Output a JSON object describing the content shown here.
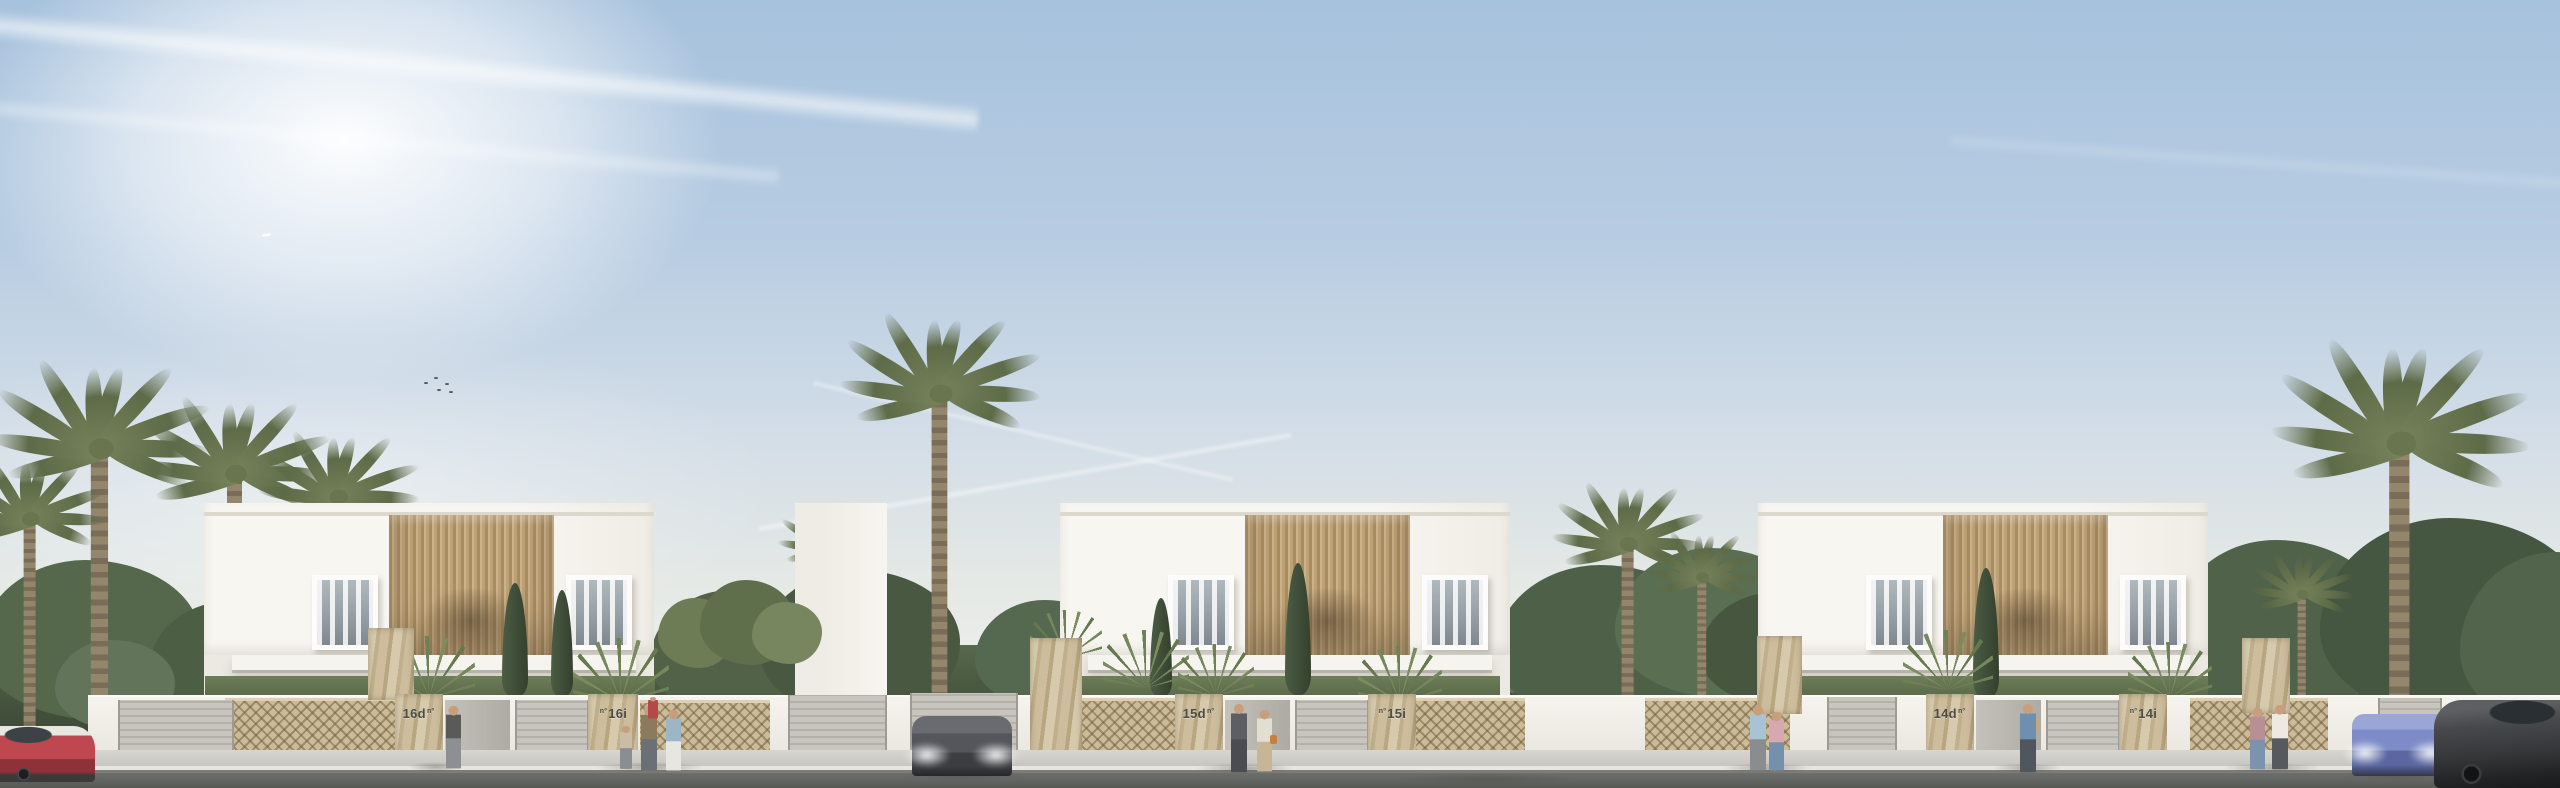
{
  "scene": {
    "setting": "Street-elevation architectural render: three identical white two-storey duplex villas with vertical wood-slat facade screens, stone gate pillars, garden walls with stone lattice panels, palm trees, pedestrians and parked cars under a clear sky with contrails and sun glow at top-left",
    "sky": {
      "sun_glow": "top-left",
      "contrail_count": 4,
      "bird_count": 5
    }
  },
  "villas": [
    {
      "block": "16",
      "plaques": [
        {
          "unit": "16d",
          "mark": "nº",
          "mark_position": "after"
        },
        {
          "unit": "16i",
          "mark": "nº",
          "mark_position": "before"
        }
      ]
    },
    {
      "block": "15",
      "plaques": [
        {
          "unit": "15d",
          "mark": "nº",
          "mark_position": "after"
        },
        {
          "unit": "15i",
          "mark": "nº",
          "mark_position": "before"
        }
      ]
    },
    {
      "block": "14",
      "plaques": [
        {
          "unit": "14d",
          "mark": "nº",
          "mark_position": "after"
        },
        {
          "unit": "14i",
          "mark": "nº",
          "mark_position": "before"
        }
      ]
    }
  ],
  "cars": [
    {
      "name": "red-hatchback-white-roof",
      "color": "#b5444c",
      "position": "far-left-street",
      "headlights_on": false
    },
    {
      "name": "dark-gray-sports-car",
      "color": "#5f6065",
      "position": "driveway-between-villas-16-and-15",
      "headlights_on": true
    },
    {
      "name": "blue-fastback-sedan",
      "color": "#5e83ac",
      "position": "street-in-front-of-villa-15",
      "headlights_on": false
    },
    {
      "name": "violet-blue-sedan",
      "color": "#7d8cc8",
      "position": "right-driveway",
      "headlights_on": true
    },
    {
      "name": "dark-gray-sedan",
      "color": "#46484b",
      "position": "far-right-street",
      "headlights_on": false
    }
  ],
  "people_groups": [
    {
      "location": "villa-16 left gate",
      "count": 1
    },
    {
      "location": "villa-16 right gate",
      "count": 4
    },
    {
      "location": "villa-15 sidewalk",
      "count": 2
    },
    {
      "location": "between villa-15 and villa-14",
      "count": 2
    },
    {
      "location": "villa-14 left gate",
      "count": 1
    },
    {
      "location": "right end of sidewalk",
      "count": 2
    }
  ],
  "palette": {
    "sky_top": "#a7c2dd",
    "sky_horizon": "#edeeea",
    "facade_white": "#f8f6f1",
    "wood_slat_light": "#ccb289",
    "wood_slat_dark": "#a98c62",
    "stone": "#d0c2a2",
    "lattice": "#cbbc99",
    "gate_gray": "#c7c5bd",
    "greenery": "#57684d",
    "cypress": "#3a4a34",
    "sidewalk": "#c6c4be",
    "asphalt": "#6d6f6c",
    "plaque_text": "#4d4c47"
  }
}
